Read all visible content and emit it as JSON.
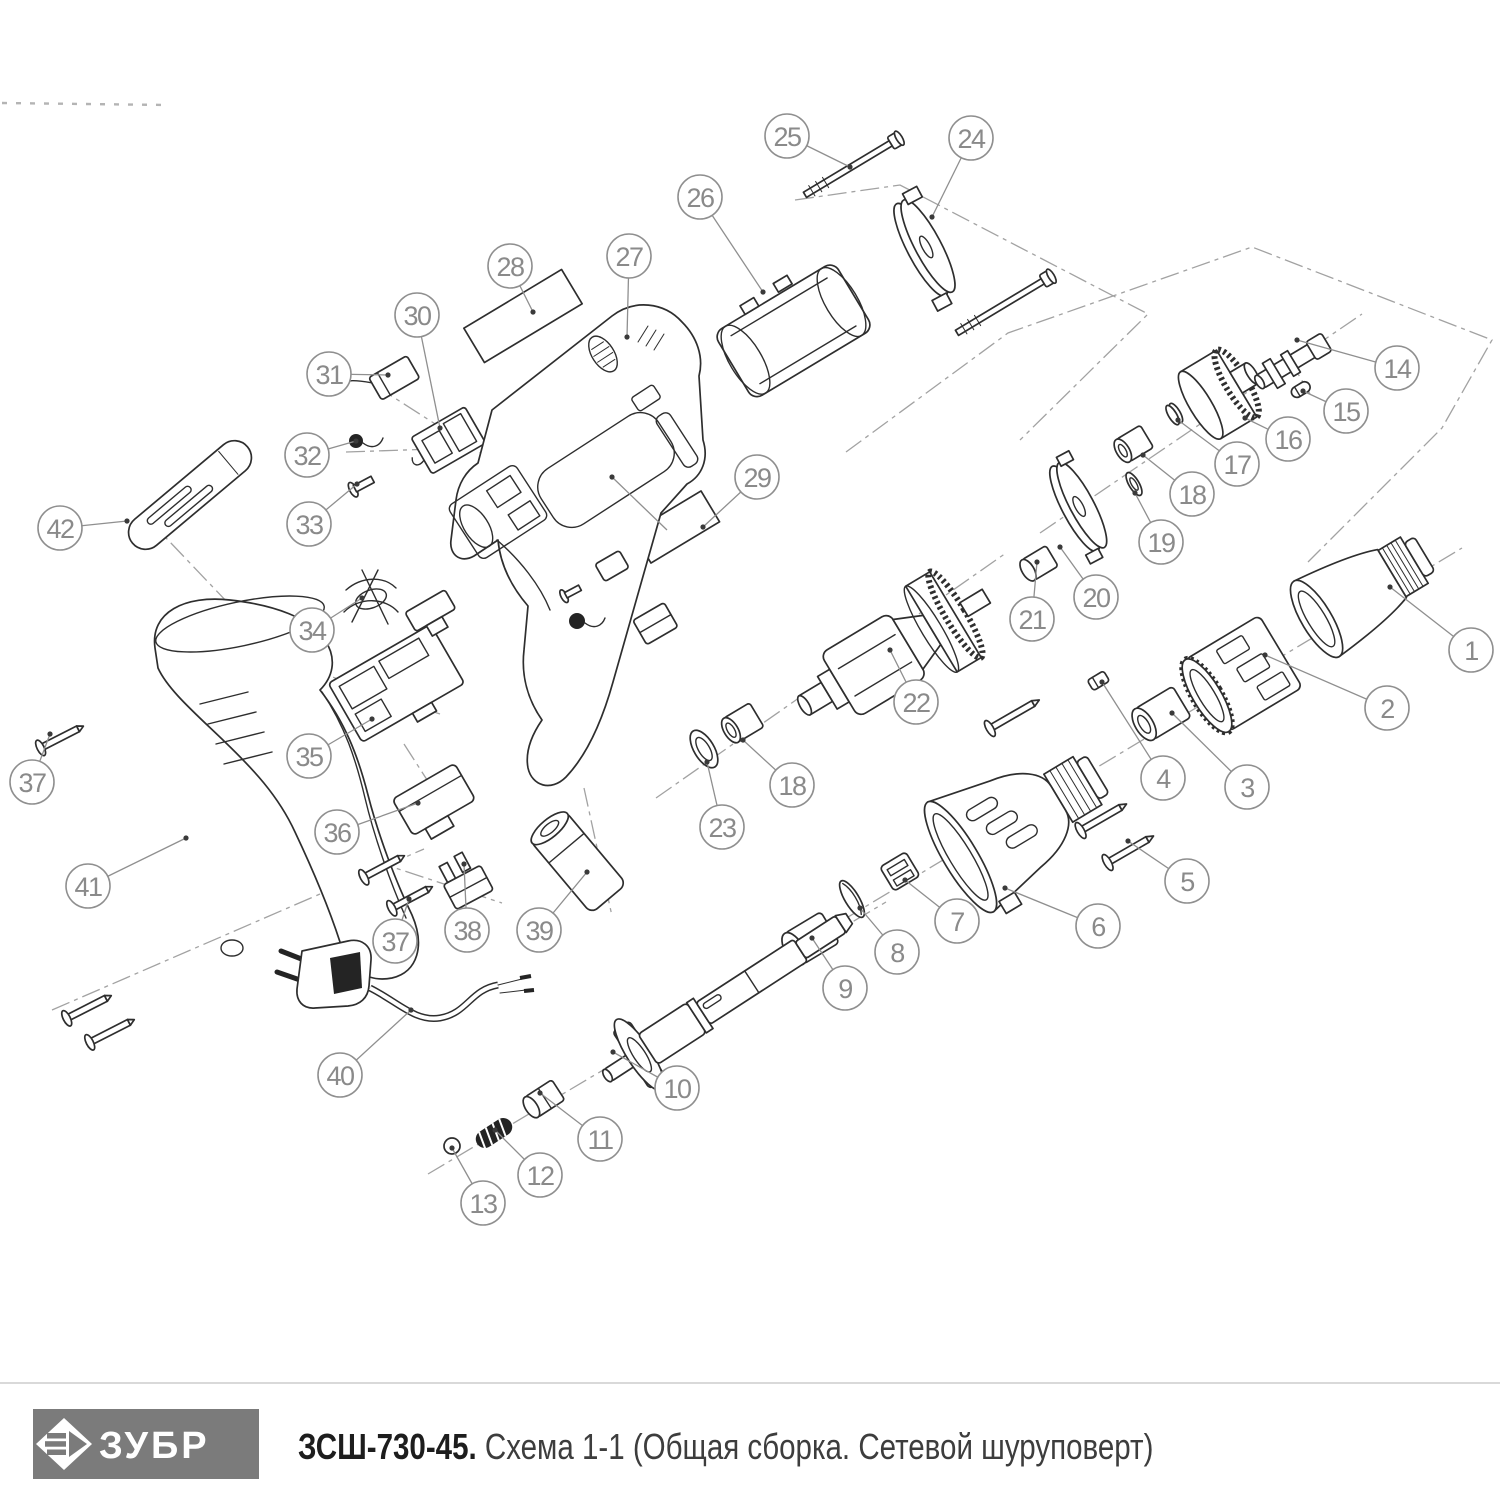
{
  "footer": {
    "brand": "ЗУБР",
    "model": "ЗСШ-730-45.",
    "subtitle": " Схема 1-1 (Общая сборка. Сетевой шуруповерт)"
  },
  "colors": {
    "line": "#2e2e2e",
    "callout": "#8f8f8f",
    "logo_bg": "#7b7b7b",
    "separator": "#d9d9d9"
  },
  "diagram": {
    "callouts": [
      {
        "n": "1"
      },
      {
        "n": "2"
      },
      {
        "n": "3"
      },
      {
        "n": "4"
      },
      {
        "n": "5"
      },
      {
        "n": "6"
      },
      {
        "n": "7"
      },
      {
        "n": "8"
      },
      {
        "n": "9"
      },
      {
        "n": "10"
      },
      {
        "n": "11"
      },
      {
        "n": "12"
      },
      {
        "n": "13"
      },
      {
        "n": "14"
      },
      {
        "n": "15"
      },
      {
        "n": "16"
      },
      {
        "n": "17"
      },
      {
        "n": "18"
      },
      {
        "n": "18"
      },
      {
        "n": "19"
      },
      {
        "n": "20"
      },
      {
        "n": "21"
      },
      {
        "n": "22"
      },
      {
        "n": "23"
      },
      {
        "n": "24"
      },
      {
        "n": "25"
      },
      {
        "n": "26"
      },
      {
        "n": "27"
      },
      {
        "n": "28"
      },
      {
        "n": "29"
      },
      {
        "n": "30"
      },
      {
        "n": "31"
      },
      {
        "n": "32"
      },
      {
        "n": "33"
      },
      {
        "n": "34"
      },
      {
        "n": "35"
      },
      {
        "n": "36"
      },
      {
        "n": "37"
      },
      {
        "n": "37"
      },
      {
        "n": "38"
      },
      {
        "n": "39"
      },
      {
        "n": "40"
      },
      {
        "n": "41"
      },
      {
        "n": "42"
      }
    ]
  }
}
